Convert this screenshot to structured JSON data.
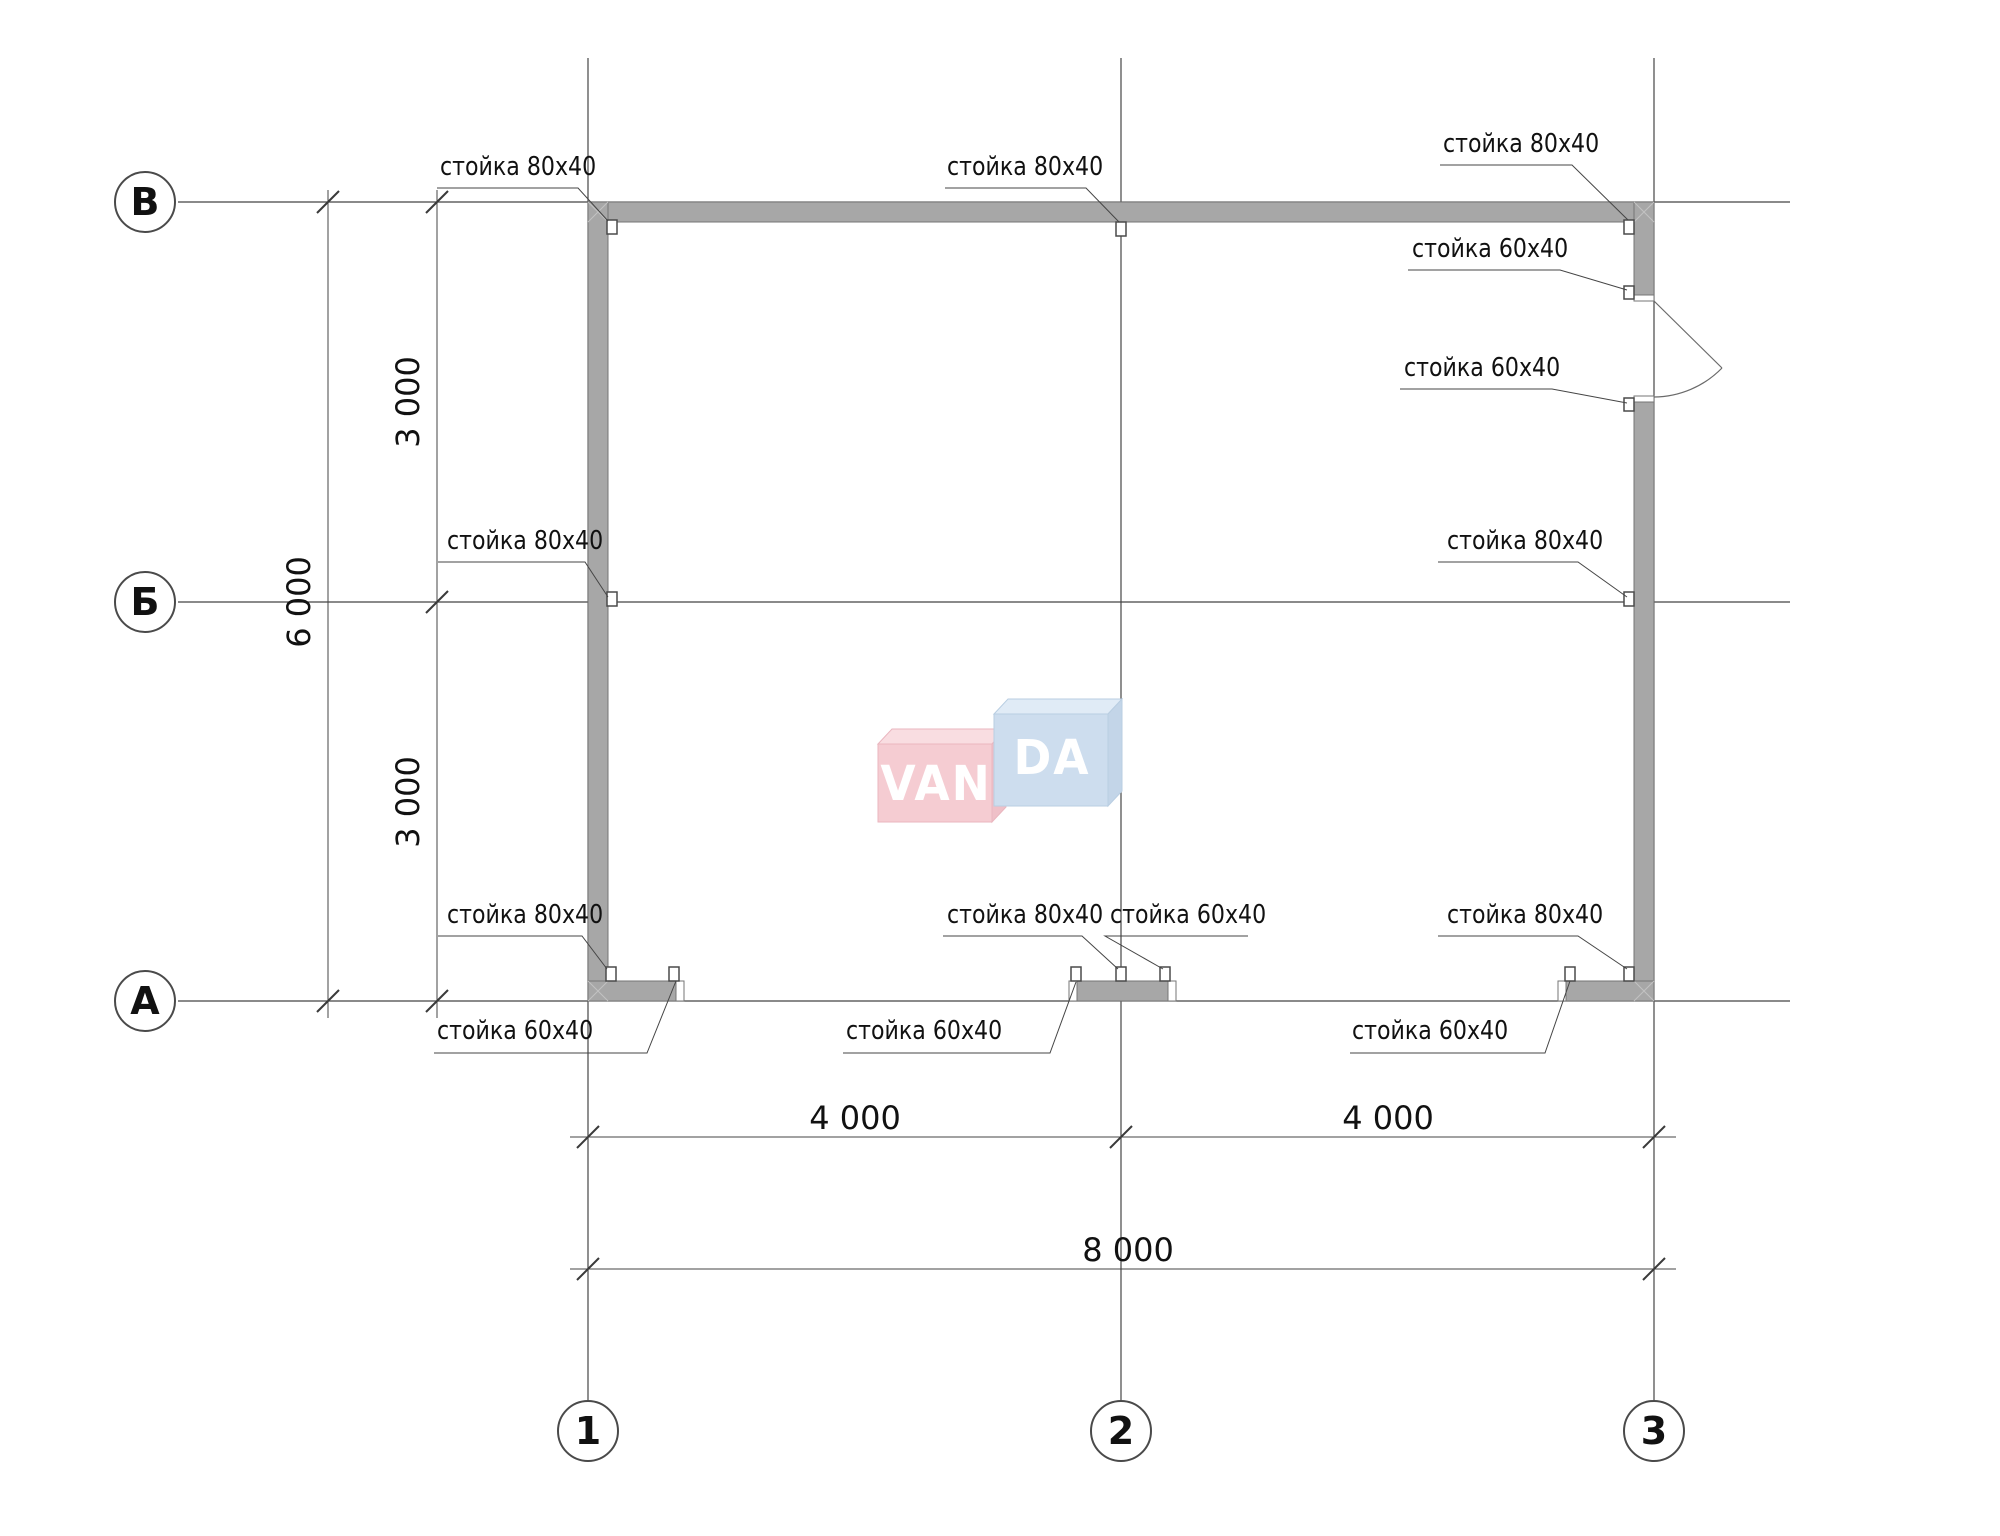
{
  "axes": {
    "horizontal": [
      {
        "id": "В"
      },
      {
        "id": "Б"
      },
      {
        "id": "А"
      }
    ],
    "vertical": [
      {
        "id": "1"
      },
      {
        "id": "2"
      },
      {
        "id": "3"
      }
    ]
  },
  "dimensions": {
    "left_segment_top": "3 000",
    "left_segment_bottom": "3 000",
    "left_total": "6 000",
    "bottom_segment_left": "4 000",
    "bottom_segment_right": "4 000",
    "bottom_total": "8 000"
  },
  "callouts": [
    {
      "text": "стойка 80х40"
    },
    {
      "text": "стойка 80х40"
    },
    {
      "text": "стойка 80х40"
    },
    {
      "text": "стойка 60х40"
    },
    {
      "text": "стойка 60х40"
    },
    {
      "text": "стойка 80х40"
    },
    {
      "text": "стойка 80х40"
    },
    {
      "text": "стойка 80х40"
    },
    {
      "text": "стойка 80х40"
    },
    {
      "text": "стойка 60х40"
    },
    {
      "text": "стойка 80х40"
    },
    {
      "text": "стойка 60х40"
    },
    {
      "text": "стойка 60х40"
    },
    {
      "text": "стойка 60х40"
    }
  ],
  "logo": {
    "text_left": "VAN",
    "text_right": "DA"
  },
  "colors": {
    "wall_fill": "#a7a7a7",
    "wall_edge": "#757575",
    "line": "#454545",
    "logo_pink": "#f5ccd2",
    "logo_pink_top": "#f9dde1",
    "logo_pink_side": "#efc0c8",
    "logo_blue": "#cdddee",
    "logo_blue_top": "#e0ebf6",
    "logo_blue_side": "#c3d5e8"
  }
}
